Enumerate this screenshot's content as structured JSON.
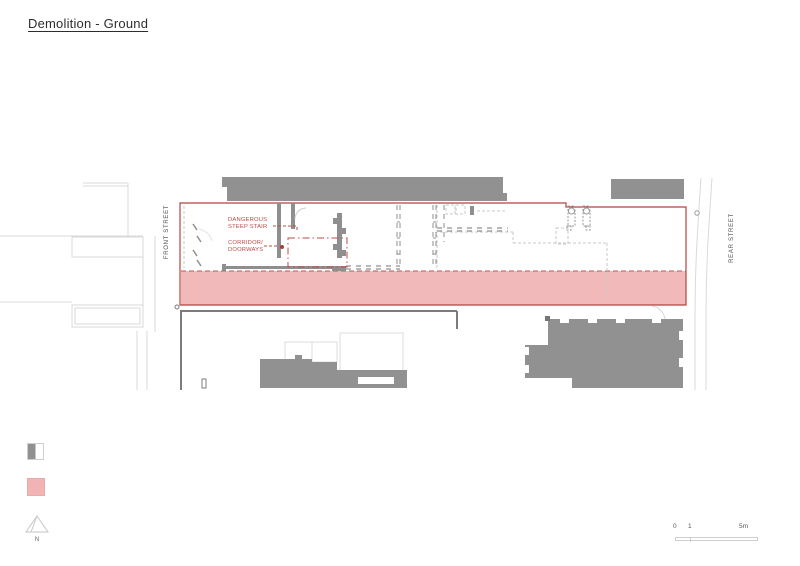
{
  "title": "Demolition - Ground",
  "plan": {
    "street_labels": {
      "front": "FRONT STREET",
      "rear": "REAR STREET"
    },
    "annotations": {
      "stair": {
        "line1": "DANGEROUS",
        "line2": "STEEP STAIR"
      },
      "corridor": {
        "line1": "CORRIDOR/",
        "line2": "DOORWAYS"
      }
    }
  },
  "legend": {
    "north_label": "N"
  },
  "scale_bar": {
    "zero": "0",
    "one": "1",
    "five": "5m"
  },
  "colors": {
    "building_gray": "#919191",
    "context_line_gray": "#d9d9d9",
    "fence_gray": "#7c7c7c",
    "demolition_pink": "#f1b9b9",
    "boundary_red": "#b0443f",
    "annotation_red": "#c04a46"
  }
}
